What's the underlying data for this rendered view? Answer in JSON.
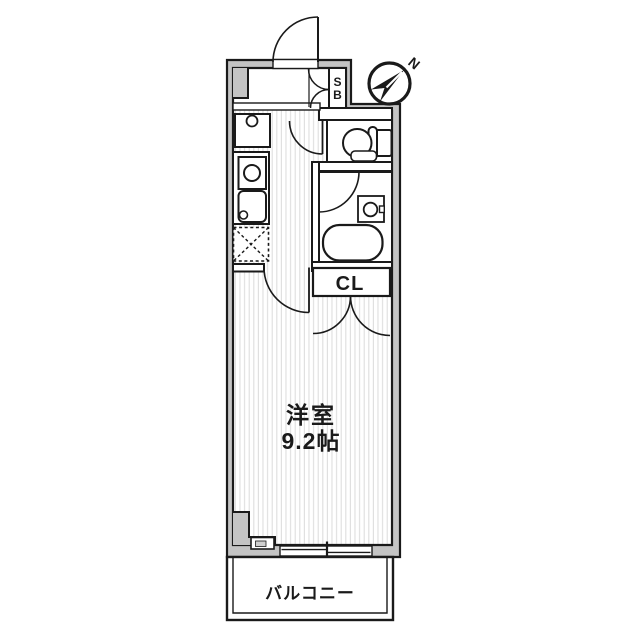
{
  "floorplan": {
    "labels": {
      "main_room": "洋室",
      "main_room_size": "9.2帖",
      "closet": "CL",
      "shoe_box_line1": "S",
      "shoe_box_line2": "B",
      "balcony": "バルコニー",
      "compass_north": "N"
    },
    "colors": {
      "wall": "#c4c4c4",
      "line": "#1a1a1a",
      "stripe": "#dedede",
      "bg": "#ffffff"
    }
  }
}
